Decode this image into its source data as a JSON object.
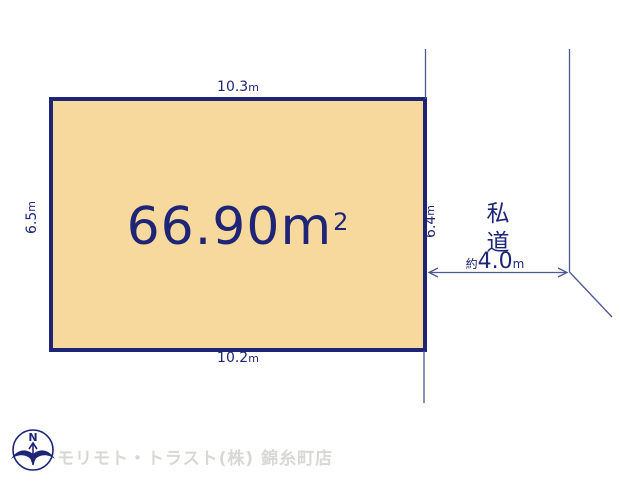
{
  "colors": {
    "navy": "#1e2577",
    "line": "#4d5896",
    "plot-fill": "#f8d99d",
    "watermark": "#d8d8d4"
  },
  "plot": {
    "area_value": "66.90",
    "area_unit": "m",
    "area_sup": "2"
  },
  "dimensions": {
    "top": {
      "value": "10.3",
      "unit": "m"
    },
    "bottom": {
      "value": "10.2",
      "unit": "m"
    },
    "left": {
      "value": "6.5",
      "unit": "m"
    },
    "right": {
      "value": "6.4",
      "unit": "m"
    }
  },
  "road": {
    "label": "私道",
    "width_prefix": "約",
    "width_value": "4.0",
    "width_unit": "m"
  },
  "compass": {
    "north_label": "N"
  },
  "footer": {
    "company_name": "モリモト・トラスト(株) 錦糸町店"
  }
}
